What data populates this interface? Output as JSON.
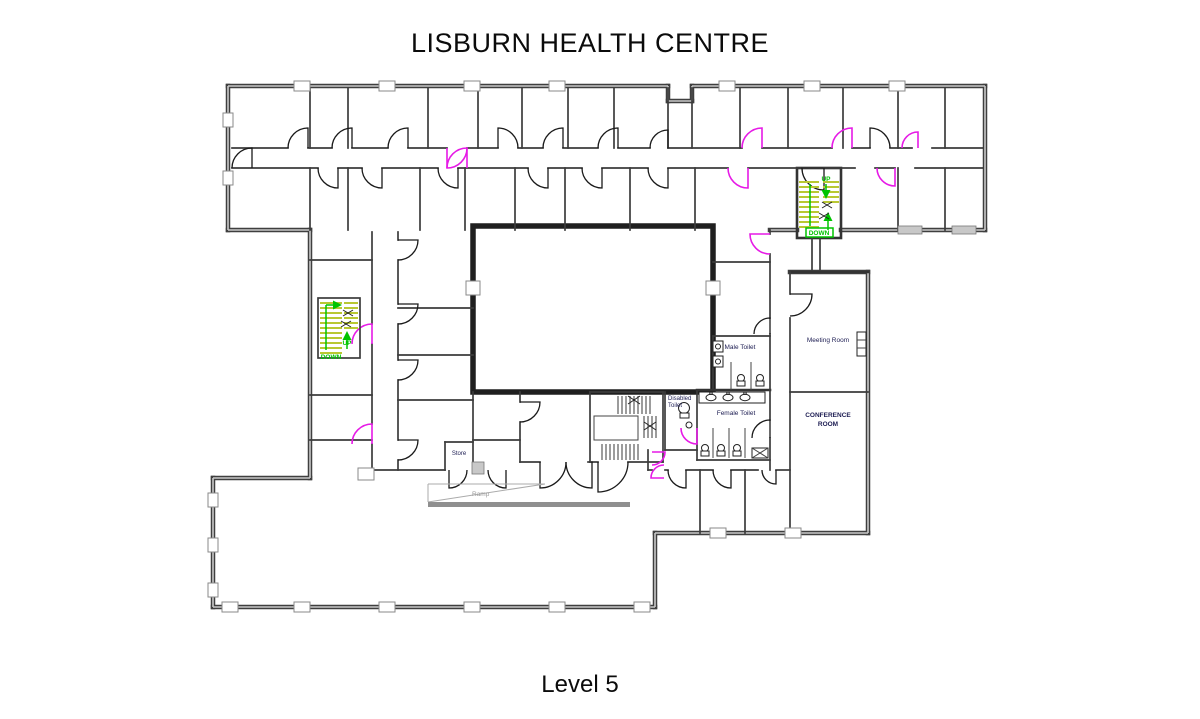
{
  "window": {
    "title": "LISBURN HEALTH CENTRE",
    "level_label": "Level 5"
  },
  "floor_plan": {
    "room_labels": {
      "meeting_room": "Meeting Room",
      "conference_line1": "CONFERENCE",
      "conference_line2": "ROOM",
      "male_toilet": "Male Toilet",
      "female_toilet": "Female Toilet",
      "disabled_line1": "Disabled",
      "disabled_line2": "Toilet",
      "store": "Store",
      "ramp": "Ramp"
    },
    "stair_labels": {
      "left_up": "UP",
      "left_down": "DOWN",
      "right_up": "UP",
      "right_down": "DOWN"
    },
    "colors": {
      "accent_door": "#e61ae6",
      "stair_tread": "#b9c832",
      "stair_annotation": "#00c400",
      "room_label": "#1c1c52"
    }
  }
}
